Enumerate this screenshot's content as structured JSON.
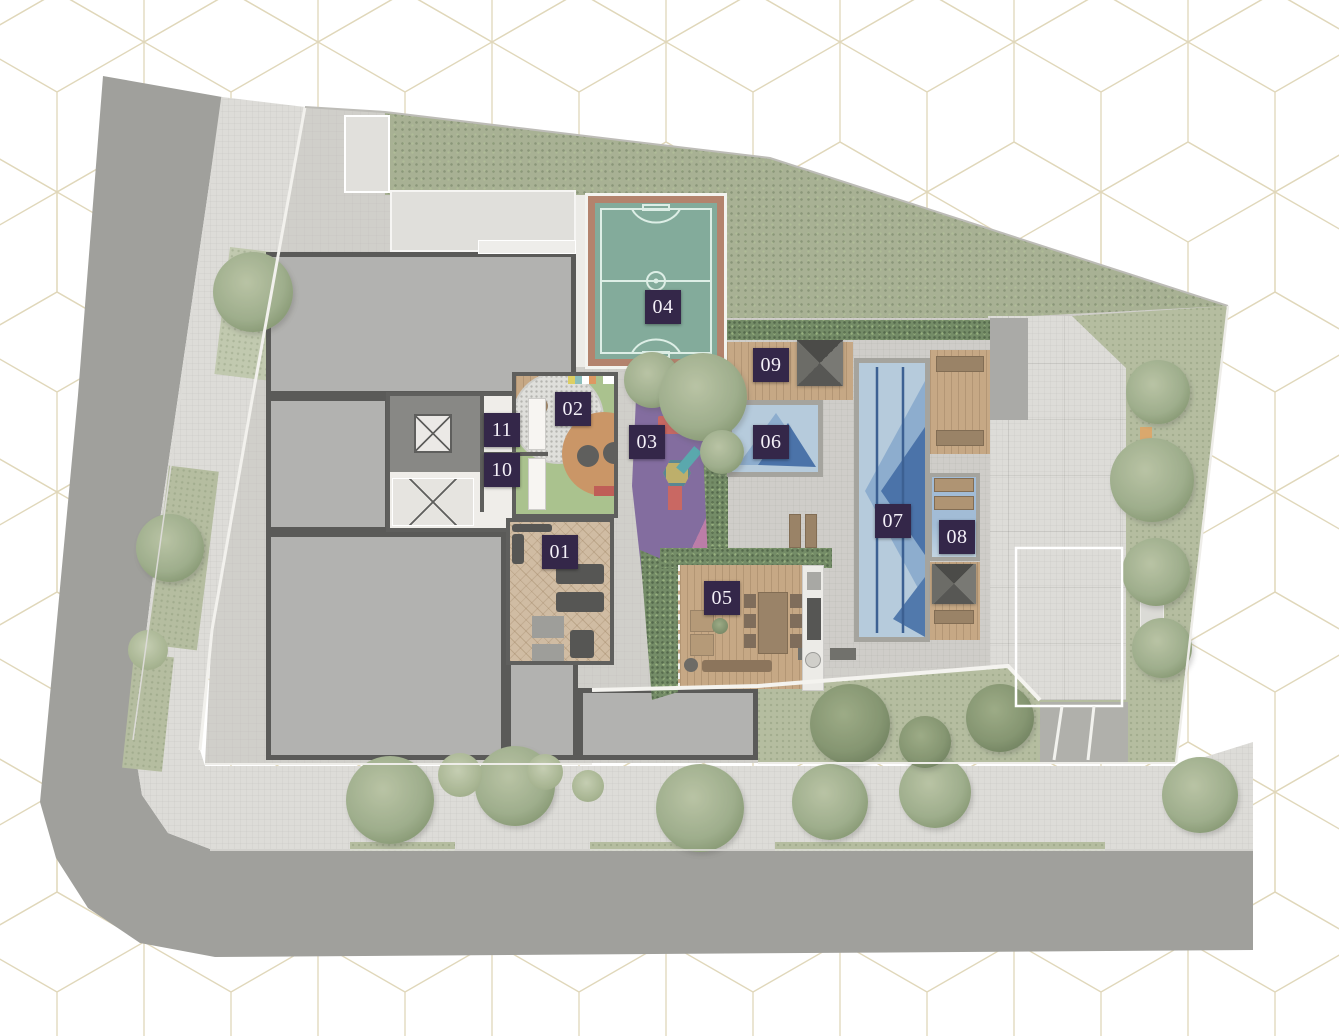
{
  "background": {
    "canvas_color": "#ffffff",
    "pattern": "isometric-cube-outline",
    "pattern_color": "#d2c69b"
  },
  "plan": {
    "markers": [
      {
        "label": "01",
        "x": 560,
        "y": 552
      },
      {
        "label": "02",
        "x": 573,
        "y": 409
      },
      {
        "label": "03",
        "x": 647,
        "y": 442
      },
      {
        "label": "04",
        "x": 663,
        "y": 307
      },
      {
        "label": "05",
        "x": 722,
        "y": 598
      },
      {
        "label": "06",
        "x": 771,
        "y": 442
      },
      {
        "label": "07",
        "x": 893,
        "y": 521
      },
      {
        "label": "08",
        "x": 957,
        "y": 537
      },
      {
        "label": "09",
        "x": 771,
        "y": 365
      },
      {
        "label": "10",
        "x": 502,
        "y": 470
      },
      {
        "label": "11",
        "x": 502,
        "y": 430
      }
    ],
    "marker_style": {
      "bg": "#342749",
      "text_color": "#f4f0f8"
    }
  },
  "palette": {
    "street": "#91918c",
    "sidewalk": "#d8d7d2",
    "site_pavement": "#c9c7c2",
    "lawn": "#a9b391",
    "hedge_green": "#5e7a4e",
    "wood_deck": "#bd9a71",
    "pool_water_light": "#aac3d7",
    "pool_water_mid": "#7ba0c6",
    "pool_water_dark": "#2e5c9b",
    "court_green": "#6f9e8b",
    "court_border": "#a76f55",
    "building_roof": "#a6a6a3",
    "building_outline": "#3f3f3d",
    "playground_pink": "#b2689a",
    "playground_teal": "#41707f",
    "playground_purple": "#6f5590",
    "playground_red": "#c0504a"
  }
}
